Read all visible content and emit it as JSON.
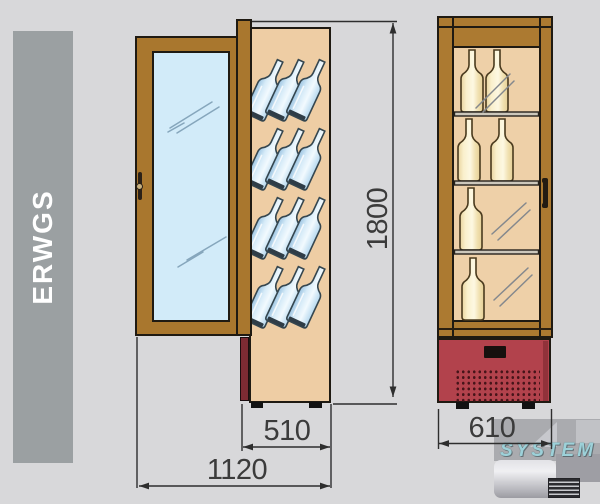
{
  "banner": {
    "label": "ERWGS"
  },
  "dimensions": {
    "height": "1800",
    "cabinet_depth": "510",
    "depth_with_door_open": "1120",
    "cabinet_width": "610"
  },
  "side_view": {
    "bottle_rows": 4,
    "bottles_per_row": 3
  },
  "front_view": {
    "shelf_count": 3,
    "sections": [
      {
        "bottles": 2
      },
      {
        "bottles": 2
      },
      {
        "bottles": 1
      },
      {
        "bottles": 1
      }
    ]
  },
  "watermark": {
    "brand": "SYSTEM"
  },
  "colors": {
    "background": "#d8d8da",
    "banner_gray": "#9ba0a2",
    "wood": "#a9772e",
    "interior_tan": "#eecda4",
    "glass_blue": "#d2ebf9",
    "bottle_cream": "#f6ecca",
    "bottle_blue": "#cfe4f4",
    "compressor_red": "#b2424c",
    "compressor_side_maroon": "#7c2b33",
    "dimension_text": "#3b3b3b"
  }
}
